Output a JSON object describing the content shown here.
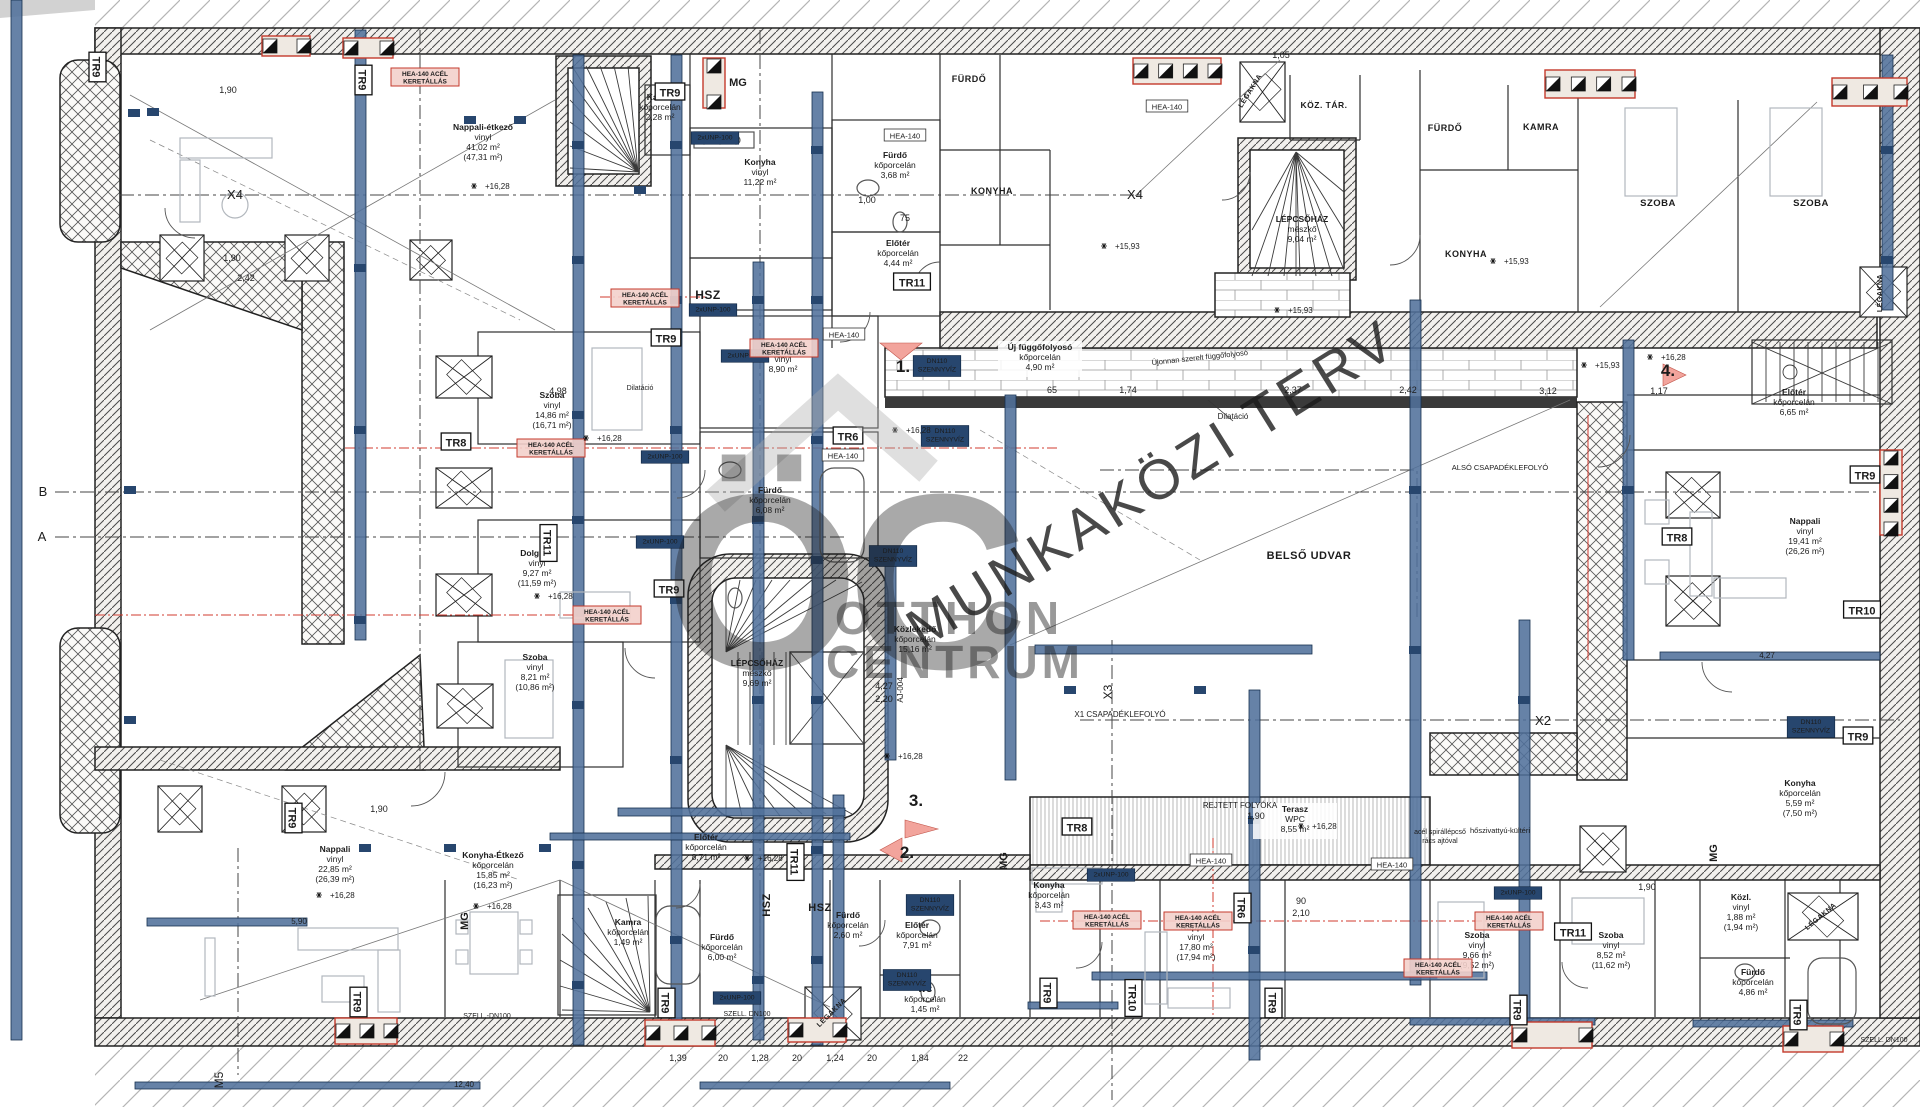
{
  "watermark": {
    "logo_text": "ÖC",
    "brand_line1": "OTTHON",
    "brand_line2": "CENTRUM",
    "diagonal_text": "MUNKAKÖZI TERV"
  },
  "colors": {
    "beam_blue": "#51719b",
    "navy": "#27466e",
    "red": "#c43a2c",
    "cyan": "#3ab5c6",
    "watermark_gray": "#a8a8a8",
    "wall_line": "#222222"
  },
  "room_labels": [
    {
      "id": "nappali-etkezo",
      "x": 483,
      "y": 130,
      "lines": [
        "Nappali-étkező",
        "vinyl",
        "41,02 m²",
        "(47,31 m²)"
      ]
    },
    {
      "id": "konyha-felso",
      "x": 760,
      "y": 165,
      "lines": [
        "Konyha",
        "vinyl",
        "11,22 m²"
      ]
    },
    {
      "id": "kamra-felso",
      "x": 660,
      "y": 100,
      "lines": [
        "Kamra",
        "kőporcelán",
        "2,28 m²"
      ]
    },
    {
      "id": "furdo-felso",
      "x": 895,
      "y": 158,
      "lines": [
        "Fürdő",
        "kőporcelán",
        "3,68 m²"
      ]
    },
    {
      "id": "eloter-felso",
      "x": 898,
      "y": 246,
      "lines": [
        "Előtér",
        "kőporcelán",
        "4,44 m²"
      ]
    },
    {
      "id": "szoba-890",
      "x": 783,
      "y": 352,
      "lines": [
        "Szoba",
        "vinyl",
        "8,90 m²"
      ]
    },
    {
      "id": "uj-fuggofolyoso",
      "x": 1040,
      "y": 350,
      "bg": true,
      "lines": [
        "Új függőfolyosó",
        "kőporcelán",
        "4,90 m²"
      ]
    },
    {
      "id": "szoba-1486",
      "x": 552,
      "y": 398,
      "lines": [
        "Szoba",
        "vinyl",
        "14,86 m²",
        "(16,71 m²)"
      ]
    },
    {
      "id": "dolgozo",
      "x": 537,
      "y": 556,
      "lines": [
        "Dolgozó",
        "vinyl",
        "9,27 m²",
        "(11,59 m²)"
      ]
    },
    {
      "id": "furdo-608",
      "x": 770,
      "y": 493,
      "lines": [
        "Fürdő",
        "kőporcelán",
        "6,08 m²"
      ]
    },
    {
      "id": "lepcsohaz-kozep",
      "x": 757,
      "y": 666,
      "lines": [
        "LÉPCSŐHÁZ",
        "mészkő",
        "9,69 m²"
      ]
    },
    {
      "id": "lepcsohaz-felso",
      "x": 1302,
      "y": 222,
      "lines": [
        "LÉPCSŐHÁZ",
        "mészkő",
        "9,04 m²"
      ]
    },
    {
      "id": "kozlekedo",
      "x": 915,
      "y": 632,
      "lines": [
        "Közlekedő",
        "kőporcelán",
        "15,16 m²"
      ]
    },
    {
      "id": "eloter-871",
      "x": 706,
      "y": 840,
      "lines": [
        "Előtér",
        "kőporcelán",
        "8,71 m²"
      ]
    },
    {
      "id": "szoba-821",
      "x": 535,
      "y": 660,
      "lines": [
        "Szoba",
        "vinyl",
        "8,21 m²",
        "(10,86 m²)"
      ]
    },
    {
      "id": "nappali-2285",
      "x": 335,
      "y": 852,
      "lines": [
        "Nappali",
        "vinyl",
        "22,85 m²",
        "(26,39 m²)"
      ]
    },
    {
      "id": "konyha-etkezo",
      "x": 493,
      "y": 858,
      "lines": [
        "Konyha-Étkező",
        "kőporcelán",
        "15,85 m²",
        "(16,23 m²)"
      ]
    },
    {
      "id": "furdo-600",
      "x": 722,
      "y": 940,
      "lines": [
        "Fürdő",
        "kőporcelán",
        "6,00 m²"
      ]
    },
    {
      "id": "kamra-also",
      "x": 628,
      "y": 925,
      "lines": [
        "Kamra",
        "kőporcelán",
        "1,49 m²"
      ]
    },
    {
      "id": "furdo-260",
      "x": 848,
      "y": 918,
      "lines": [
        "Fürdő",
        "kőporcelán",
        "2,60 m²"
      ]
    },
    {
      "id": "eloter-791",
      "x": 917,
      "y": 928,
      "lines": [
        "Előtér",
        "kőporcelán",
        "7,91 m²"
      ]
    },
    {
      "id": "wc",
      "x": 925,
      "y": 992,
      "lines": [
        "WC",
        "kőporcelán",
        "1,45 m²"
      ]
    },
    {
      "id": "konyha-343",
      "x": 1049,
      "y": 888,
      "lines": [
        "Konyha",
        "kőporcelán",
        "3,43 m²"
      ]
    },
    {
      "id": "nappali-1780",
      "x": 1196,
      "y": 930,
      "lines": [
        "Nappali",
        "vinyl",
        "17,80 m²",
        "(17,94 m²)"
      ]
    },
    {
      "id": "terasz",
      "x": 1295,
      "y": 812,
      "bg": true,
      "lines": [
        "Terasz",
        "WPC",
        "8,55 m²"
      ]
    },
    {
      "id": "szoba-966",
      "x": 1477,
      "y": 938,
      "lines": [
        "Szoba",
        "vinyl",
        "9,66 m²",
        "(9,52 m²)"
      ]
    },
    {
      "id": "szoba-852",
      "x": 1611,
      "y": 938,
      "lines": [
        "Szoba",
        "vinyl",
        "8,52 m²",
        "(11,62 m²)"
      ]
    },
    {
      "id": "kozl",
      "x": 1741,
      "y": 900,
      "lines": [
        "Közl.",
        "vinyl",
        "1,88 m²",
        "(1,94 m²)"
      ]
    },
    {
      "id": "furdo-486",
      "x": 1753,
      "y": 975,
      "lines": [
        "Fürdő",
        "kőporcelán",
        "4,86 m²"
      ]
    },
    {
      "id": "konyha-559",
      "x": 1800,
      "y": 786,
      "lines": [
        "Konyha",
        "kőporcelán",
        "5,59 m²",
        "(7,50 m²)"
      ]
    },
    {
      "id": "nappali-1941",
      "x": 1805,
      "y": 524,
      "lines": [
        "Nappali",
        "vinyl",
        "19,41 m²",
        "(26,26 m²)"
      ]
    },
    {
      "id": "eloter-665",
      "x": 1794,
      "y": 395,
      "lines": [
        "Előtér",
        "kőporcelán",
        "6,65 m²"
      ]
    }
  ],
  "caps_labels": [
    {
      "text": "FÜRDŐ",
      "x": 969,
      "y": 82,
      "s": 9
    },
    {
      "text": "KONYHA",
      "x": 992,
      "y": 194,
      "s": 9
    },
    {
      "text": "KÖZ. TÁR.",
      "x": 1324,
      "y": 108,
      "s": 8.5
    },
    {
      "text": "FÜRDŐ",
      "x": 1445,
      "y": 131,
      "s": 9
    },
    {
      "text": "KAMRA",
      "x": 1541,
      "y": 130,
      "s": 9
    },
    {
      "text": "SZOBA",
      "x": 1658,
      "y": 206,
      "s": 9.5
    },
    {
      "text": "SZOBA",
      "x": 1811,
      "y": 206,
      "s": 9.5
    },
    {
      "text": "KONYHA",
      "x": 1466,
      "y": 257,
      "s": 9
    },
    {
      "text": "BELSŐ UDVAR",
      "x": 1309,
      "y": 559,
      "s": 11
    },
    {
      "text": "HSZ",
      "x": 708,
      "y": 299,
      "s": 12
    },
    {
      "text": "HSZ",
      "x": 820,
      "y": 911,
      "s": 11
    },
    {
      "text": "HSZ",
      "x": 770,
      "y": 905,
      "s": 11,
      "r": -90
    },
    {
      "text": "LÉGAKNA",
      "x": 1252,
      "y": 92,
      "s": 7,
      "r": -58
    },
    {
      "text": "LÉGAKNA",
      "x": 1882,
      "y": 293,
      "s": 7,
      "r": -90
    },
    {
      "text": "LÉGAKNA",
      "x": 833,
      "y": 1014,
      "s": 7,
      "r": -45
    },
    {
      "text": "LÉGAKNA",
      "x": 1822,
      "y": 918,
      "s": 7,
      "r": -40
    }
  ],
  "tr_markers": [
    {
      "text": "TR9",
      "x": 97,
      "y": 67,
      "r": 90
    },
    {
      "text": "TR9",
      "x": 363,
      "y": 80,
      "r": 90
    },
    {
      "text": "TR9",
      "x": 670,
      "y": 92
    },
    {
      "text": "TR9",
      "x": 666,
      "y": 338
    },
    {
      "text": "TR8",
      "x": 456,
      "y": 442
    },
    {
      "text": "TR11",
      "x": 548,
      "y": 543,
      "r": 90
    },
    {
      "text": "TR6",
      "x": 848,
      "y": 436
    },
    {
      "text": "TR11",
      "x": 912,
      "y": 282
    },
    {
      "text": "TR9",
      "x": 669,
      "y": 589
    },
    {
      "text": "TR11",
      "x": 795,
      "y": 862,
      "r": 90
    },
    {
      "text": "TR9",
      "x": 293,
      "y": 818,
      "r": 90
    },
    {
      "text": "TR9",
      "x": 358,
      "y": 1002,
      "r": 90
    },
    {
      "text": "TR9",
      "x": 666,
      "y": 1003,
      "r": 90
    },
    {
      "text": "TR8",
      "x": 1077,
      "y": 827
    },
    {
      "text": "TR6",
      "x": 1242,
      "y": 908,
      "r": 90
    },
    {
      "text": "TR9",
      "x": 1048,
      "y": 993,
      "r": 90
    },
    {
      "text": "TR10",
      "x": 1133,
      "y": 998,
      "r": 90
    },
    {
      "text": "TR9",
      "x": 1273,
      "y": 1003,
      "r": 90
    },
    {
      "text": "TR11",
      "x": 1573,
      "y": 932
    },
    {
      "text": "TR9",
      "x": 1518,
      "y": 1010,
      "r": 90
    },
    {
      "text": "TR9",
      "x": 1798,
      "y": 1015,
      "r": 90
    },
    {
      "text": "TR9",
      "x": 1865,
      "y": 475
    },
    {
      "text": "TR8",
      "x": 1677,
      "y": 537
    },
    {
      "text": "TR10",
      "x": 1862,
      "y": 610
    },
    {
      "text": "TR9",
      "x": 1858,
      "y": 736
    }
  ],
  "steel_tags": [
    {
      "text": "HEA-140",
      "x": 1167,
      "y": 107
    },
    {
      "text": "HEA-140",
      "x": 905,
      "y": 136
    },
    {
      "text": "HEA-140",
      "x": 844,
      "y": 335
    },
    {
      "text": "HEA-140",
      "x": 843,
      "y": 456
    },
    {
      "text": "HEA-140",
      "x": 1211,
      "y": 861
    },
    {
      "text": "HEA-140",
      "x": 1392,
      "y": 865
    }
  ],
  "navy_tags": [
    {
      "lines": [
        "2xUNP-100"
      ],
      "x": 715,
      "y": 138
    },
    {
      "lines": [
        "2xUNP-100"
      ],
      "x": 713,
      "y": 310
    },
    {
      "lines": [
        "2xUNP-100"
      ],
      "x": 745,
      "y": 356
    },
    {
      "lines": [
        "2xUNP-100"
      ],
      "x": 665,
      "y": 457
    },
    {
      "lines": [
        "2xUNP-100"
      ],
      "x": 660,
      "y": 542
    },
    {
      "lines": [
        "2xUNP-100"
      ],
      "x": 1111,
      "y": 875
    },
    {
      "lines": [
        "2xUNP-100"
      ],
      "x": 737,
      "y": 998
    },
    {
      "lines": [
        "2xUNP-100"
      ],
      "x": 1518,
      "y": 893
    },
    {
      "lines": [
        "DN110",
        "SZENNYVÍZ"
      ],
      "x": 937,
      "y": 366
    },
    {
      "lines": [
        "DN110",
        "SZENNYVÍZ"
      ],
      "x": 945,
      "y": 436
    },
    {
      "lines": [
        "DN110",
        "SZENNYVÍZ"
      ],
      "x": 893,
      "y": 556
    },
    {
      "lines": [
        "DN110",
        "SZENNYVÍZ"
      ],
      "x": 930,
      "y": 905
    },
    {
      "lines": [
        "DN110",
        "SZENNYVÍZ"
      ],
      "x": 907,
      "y": 980
    },
    {
      "lines": [
        "DN110",
        "SZENNYVÍZ"
      ],
      "x": 1811,
      "y": 727
    }
  ],
  "red_tags": [
    {
      "x": 425,
      "y": 77
    },
    {
      "x": 645,
      "y": 298
    },
    {
      "x": 784,
      "y": 348
    },
    {
      "x": 551,
      "y": 448
    },
    {
      "x": 607,
      "y": 615
    },
    {
      "x": 1107,
      "y": 920
    },
    {
      "x": 1198,
      "y": 921
    },
    {
      "x": 1438,
      "y": 968
    },
    {
      "x": 1509,
      "y": 921
    }
  ],
  "red_tag_lines": [
    "HEA-140 ACÉL",
    "KERETÁLLÁS"
  ],
  "cyan_marks": [
    {
      "text": "1.",
      "x": 903,
      "y": 372,
      "s": 17
    },
    {
      "text": "2.",
      "x": 907,
      "y": 858,
      "s": 17
    },
    {
      "text": "3.",
      "x": 916,
      "y": 806,
      "s": 17
    },
    {
      "text": "4.",
      "x": 1668,
      "y": 376,
      "s": 17
    },
    {
      "text": "MG",
      "x": 738,
      "y": 86,
      "s": 11
    },
    {
      "text": "MG",
      "x": 468,
      "y": 921,
      "s": 11,
      "r": -90
    },
    {
      "text": "MG",
      "x": 1007,
      "y": 861,
      "s": 11,
      "r": -90
    },
    {
      "text": "MG",
      "x": 1717,
      "y": 853,
      "s": 11,
      "r": -90
    }
  ],
  "axis_marks": [
    {
      "text": "B",
      "x": 43,
      "y": 496,
      "s": 13
    },
    {
      "text": "A",
      "x": 42,
      "y": 541,
      "s": 13
    },
    {
      "text": "X4",
      "x": 235,
      "y": 199,
      "s": 13
    },
    {
      "text": "X4",
      "x": 1135,
      "y": 199,
      "s": 13
    },
    {
      "text": "X2",
      "x": 1543,
      "y": 725,
      "s": 13
    },
    {
      "text": "X3",
      "x": 1112,
      "y": 692,
      "s": 12,
      "r": -90
    },
    {
      "text": "M5",
      "x": 223,
      "y": 1080,
      "s": 12,
      "r": -90
    },
    {
      "text": "X1 CSAPADÉKLEFOLYÓ",
      "x": 1120,
      "y": 717,
      "s": 8
    }
  ],
  "annotations": [
    {
      "text": "Dilatáció",
      "x": 1233,
      "y": 419,
      "s": 8
    },
    {
      "text": "REJTETT FOLYÓKA",
      "x": 1240,
      "y": 808,
      "s": 8
    },
    {
      "text": "hőszivattyú-kültéri",
      "x": 1500,
      "y": 833,
      "s": 7.5
    },
    {
      "text": "ALSÓ CSAPADÉKLEFOLYÓ",
      "x": 1500,
      "y": 470,
      "s": 7.5
    },
    {
      "text": "Újonnan szerelt függőfolyosó",
      "x": 1200,
      "y": 360,
      "s": 7.5,
      "r": -6
    },
    {
      "text": "acél spirállépcső",
      "x": 1440,
      "y": 834,
      "s": 7
    },
    {
      "text": "rács ajtóval",
      "x": 1440,
      "y": 843,
      "s": 7
    },
    {
      "text": "AJ-004",
      "x": 903,
      "y": 690,
      "s": 8,
      "r": -90
    },
    {
      "text": "SZELL. DN100",
      "x": 747,
      "y": 1016,
      "s": 7
    },
    {
      "text": "SZELL.-DN100",
      "x": 487,
      "y": 1018,
      "s": 7
    },
    {
      "text": "SZELL. DN100",
      "x": 1884,
      "y": 1042,
      "s": 7
    },
    {
      "text": "Dilatáció",
      "x": 640,
      "y": 390,
      "s": 7
    }
  ],
  "elevations": [
    {
      "text": "+16,28",
      "x": 485,
      "y": 186
    },
    {
      "text": "+16,28",
      "x": 906,
      "y": 430
    },
    {
      "text": "+16,28",
      "x": 597,
      "y": 438
    },
    {
      "text": "+16,28",
      "x": 548,
      "y": 596
    },
    {
      "text": "+16,28",
      "x": 898,
      "y": 756
    },
    {
      "text": "+16,28",
      "x": 758,
      "y": 858
    },
    {
      "text": "+16,28",
      "x": 330,
      "y": 895
    },
    {
      "text": "+16,28",
      "x": 487,
      "y": 906
    },
    {
      "text": "+16,28",
      "x": 1312,
      "y": 826
    },
    {
      "text": "+16,28",
      "x": 1661,
      "y": 357
    },
    {
      "text": "+15,93",
      "x": 1115,
      "y": 246
    },
    {
      "text": "+15,93",
      "x": 1288,
      "y": 310
    },
    {
      "text": "+15,93",
      "x": 1504,
      "y": 261
    },
    {
      "text": "+15,93",
      "x": 1595,
      "y": 365
    }
  ],
  "dimensions": [
    {
      "text": "1,90",
      "x": 228,
      "y": 93
    },
    {
      "text": "1,90",
      "x": 232,
      "y": 261
    },
    {
      "text": "2,42",
      "x": 246,
      "y": 281
    },
    {
      "text": "1,90",
      "x": 379,
      "y": 812
    },
    {
      "text": "1,90",
      "x": 1256,
      "y": 819
    },
    {
      "text": "1,90",
      "x": 1647,
      "y": 890
    },
    {
      "text": "65",
      "x": 1052,
      "y": 393
    },
    {
      "text": "1,74",
      "x": 1128,
      "y": 393
    },
    {
      "text": "2,37",
      "x": 1293,
      "y": 393
    },
    {
      "text": "2,42",
      "x": 1408,
      "y": 393
    },
    {
      "text": "3,12",
      "x": 1548,
      "y": 394
    },
    {
      "text": "1,17",
      "x": 1659,
      "y": 394
    },
    {
      "text": "4,98",
      "x": 558,
      "y": 394
    },
    {
      "text": "4,27",
      "x": 884,
      "y": 689
    },
    {
      "text": "2,20",
      "x": 884,
      "y": 702
    },
    {
      "text": "90",
      "x": 1301,
      "y": 904
    },
    {
      "text": "2,10",
      "x": 1301,
      "y": 916
    },
    {
      "text": "1,00",
      "x": 867,
      "y": 203
    },
    {
      "text": "75",
      "x": 905,
      "y": 221
    },
    {
      "text": "1,05",
      "x": 1281,
      "y": 58
    },
    {
      "text": "1,39",
      "x": 678,
      "y": 1061
    },
    {
      "text": "20",
      "x": 723,
      "y": 1061
    },
    {
      "text": "1,28",
      "x": 760,
      "y": 1061
    },
    {
      "text": "20",
      "x": 797,
      "y": 1061
    },
    {
      "text": "1,24",
      "x": 835,
      "y": 1061
    },
    {
      "text": "20",
      "x": 872,
      "y": 1061
    },
    {
      "text": "1,84",
      "x": 920,
      "y": 1061
    },
    {
      "text": "22",
      "x": 963,
      "y": 1061
    },
    {
      "text": "5,90",
      "x": 299,
      "y": 924,
      "w": true
    },
    {
      "text": "12,40",
      "x": 464,
      "y": 1087,
      "w": true
    },
    {
      "text": "4,27",
      "x": 1767,
      "y": 658,
      "w": true
    }
  ]
}
